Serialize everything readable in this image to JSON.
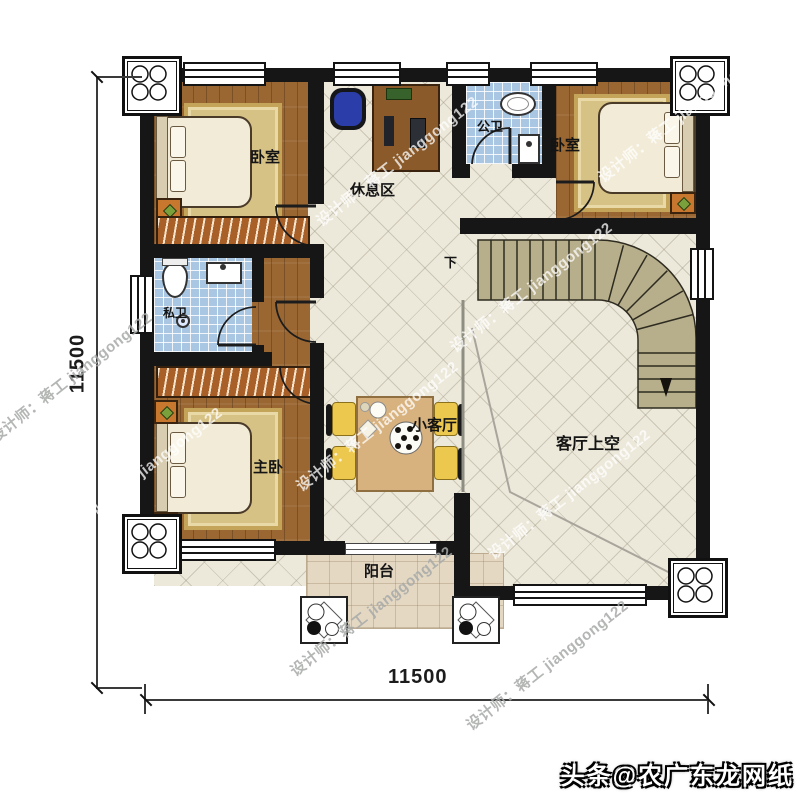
{
  "rooms": {
    "bedroom_top_left": "卧室",
    "bedroom_top_right": "卧室",
    "master_bedroom": "主卧",
    "private_bathroom": "私卫",
    "public_bathroom": "公卫",
    "rest_area": "休息区",
    "small_living_room": "小客厅",
    "living_room_void": "客厅上空",
    "balcony": "阳台",
    "stairs_down": "下"
  },
  "dimensions": {
    "bottom": "11500",
    "left": "11500"
  },
  "watermark": "设计师：蒋工 jianggong122",
  "caption": "头条@农广东龙网纸",
  "colors": {
    "wall": "#161616",
    "wood_floor": "#9a6733",
    "tile_floor": "#ece8da",
    "bath_tile": "#a9c6e2",
    "balcony_floor": "#e5d8c3",
    "stairs": "#b7ae8b",
    "rug": "#d7c286"
  }
}
